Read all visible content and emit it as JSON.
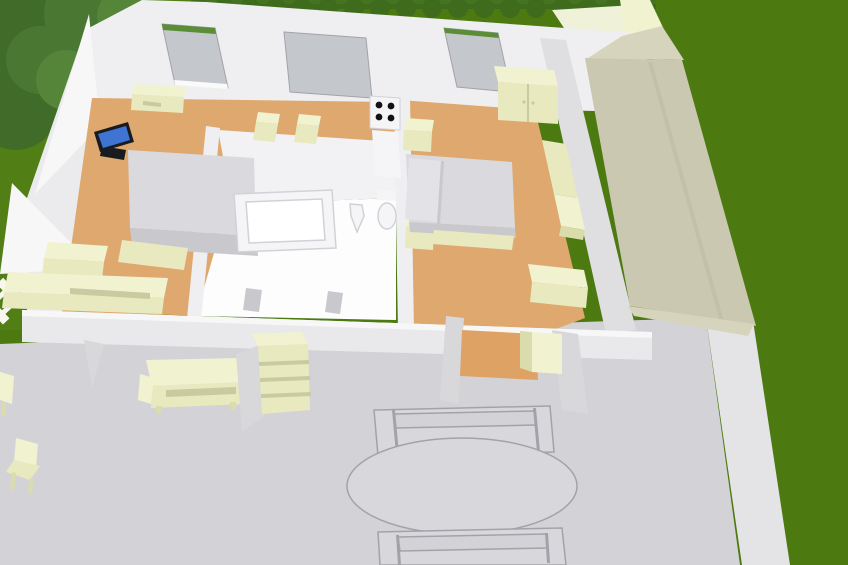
{
  "scene": {
    "description": "3D aerial cutaway rendering of a single-storey house with garden, hedge, picket fence, roofed wing and furnished patio",
    "rooms": [
      "bedroom-kitchen",
      "bathroom",
      "bedroom",
      "entry-alcove"
    ],
    "objects": {
      "left_room": [
        "double-bed",
        "wall-tv",
        "dresser",
        "two-stools",
        "stove-cooktop",
        "counter",
        "low-cabinets"
      ],
      "bathroom": [
        "bathtub",
        "wash-basin",
        "toilet",
        "two-floor-fixtures"
      ],
      "right_room": [
        "double-bed-with-pillows",
        "nightstand",
        "nightstand",
        "wardrobe",
        "sofa",
        "chest"
      ],
      "alcove": [
        "cabinet"
      ],
      "patio": [
        "oval-table",
        "garden-bench-top",
        "garden-bench-bottom",
        "sideboard",
        "shelf-unit",
        "garden-chairs"
      ],
      "garden": [
        "trees",
        "picket-fence",
        "hedge",
        "lawn",
        "roof-wing"
      ]
    }
  },
  "colors": {
    "grass": "#4c7a10",
    "grass_light": "#578419",
    "patio": "#d3d3d7",
    "patio_edge": "#e4e4e6",
    "fence": "#f7f7f0",
    "tree_dark": "#406b29",
    "tree_mid": "#4a7732",
    "tree_light": "#548539",
    "trunk": "#7f6947",
    "hedge": "#3e6c1c",
    "hedge_light": "#497a23",
    "wall": "#efeff1",
    "wall_bright": "#f7f7f8",
    "wall_left": "#ebebed",
    "wall_gray": "#dfdfe2",
    "front_wall": "#e9e9eb",
    "wall_cut": "#d8d8da",
    "window_gray": "#c4c8cd",
    "window_green": "#5b8d37",
    "sill": "#fafafa",
    "floor_tan": "#dfa86e",
    "alcove_floor": "#dfa265",
    "bath_wall": "#f2f2f4",
    "bath_floor": "#fdfdfe",
    "cream_top": "#f1f2d0",
    "cream_front": "#e8e9be",
    "cream_dark": "#dadcab",
    "cream_edge": "#c8caa0",
    "bed_gray": "#c9c9cd",
    "bed_light": "#dadade",
    "pillow": "#e3e3e7",
    "roof": "#cac8b0",
    "roof_light": "#d6d4bc",
    "roof_edge": "#bdbba3",
    "fixture": "#f5f5f7",
    "fixture_line": "#d2d2d6",
    "outline": "#a2a2a8",
    "table_fill": "#d8d8dc",
    "pale_floor": "#eff1d8",
    "tv_screen": "#3f74d4",
    "tv_dark": "#181c20",
    "cooktop": "#131313"
  }
}
